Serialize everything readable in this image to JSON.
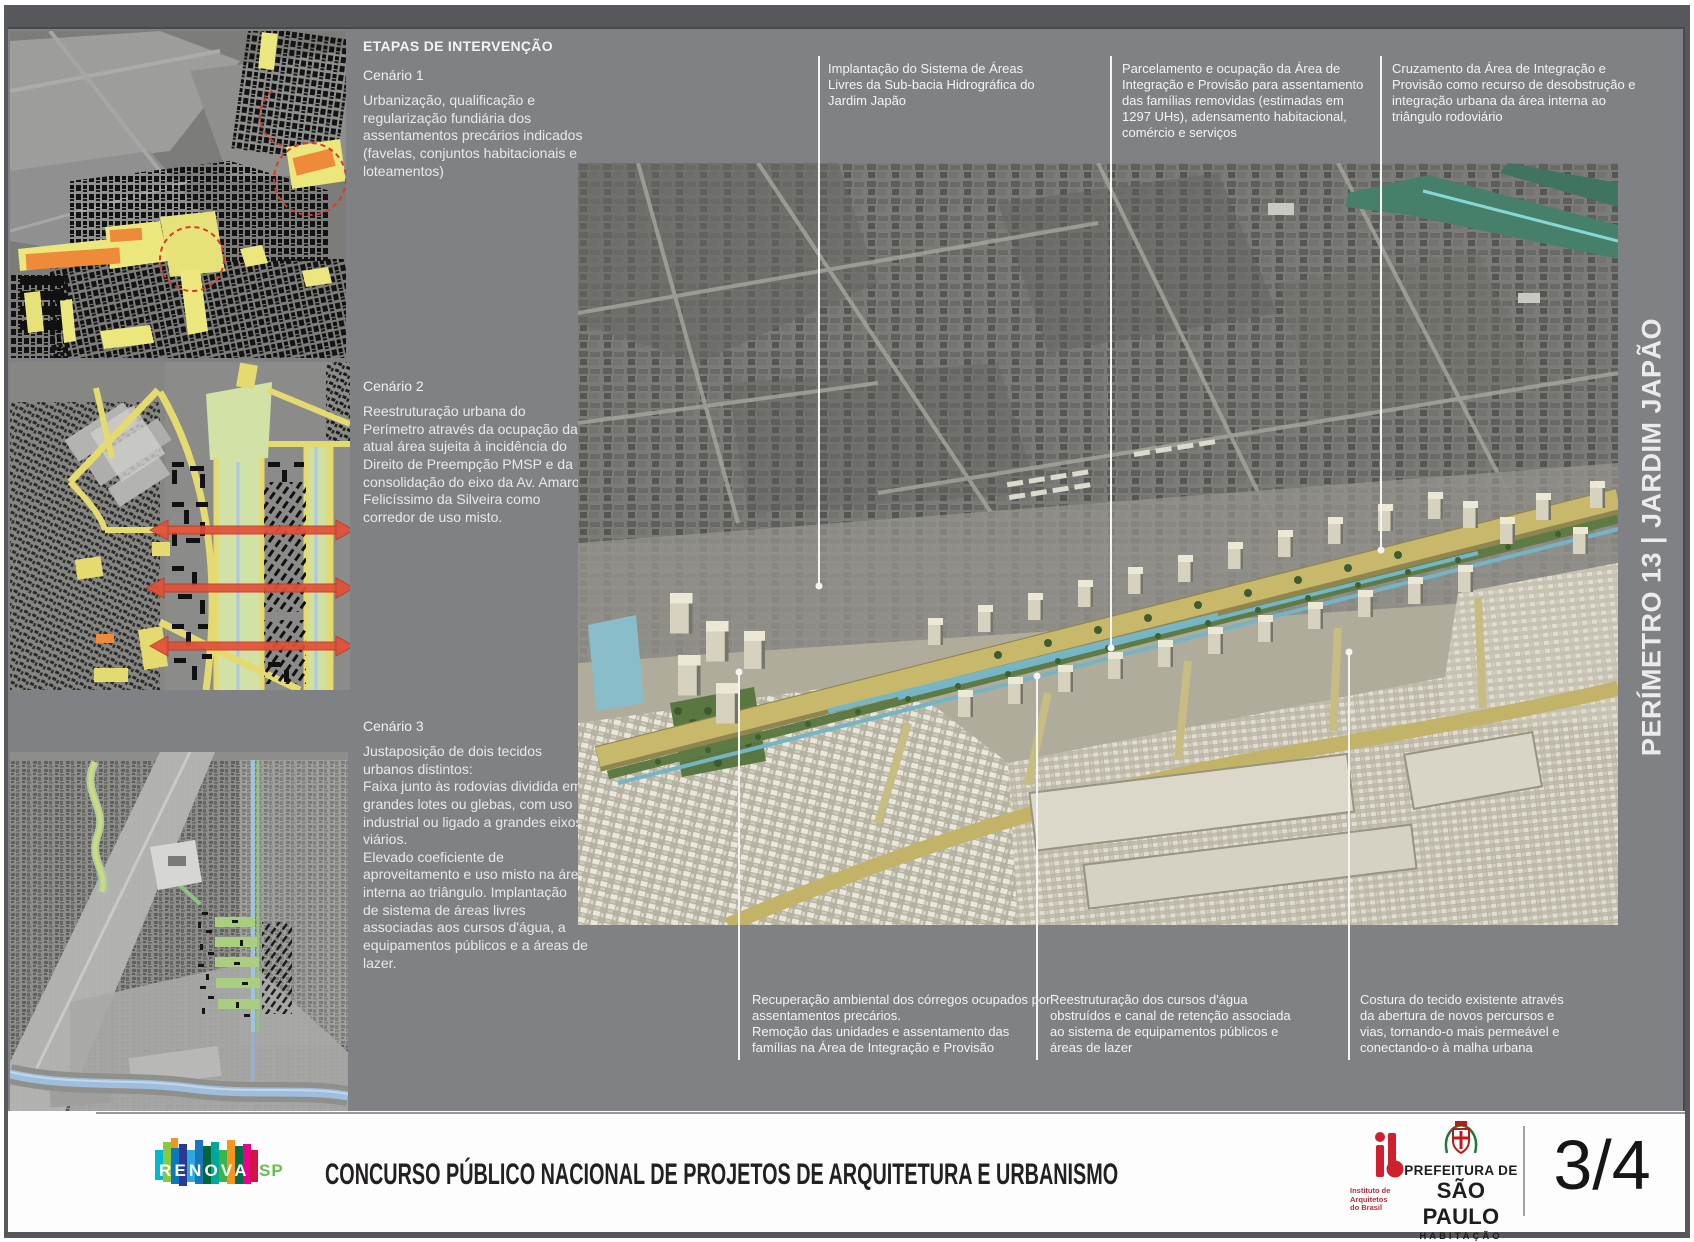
{
  "text_column": {
    "heading": "ETAPAS DE INTERVENÇÃO",
    "scenarios": [
      {
        "title": "Cenário 1",
        "body": "Urbanização, qualificação e\nregularização fundiária dos\nassentamentos precários indicados\n(favelas, conjuntos habitacionais e\nloteamentos)"
      },
      {
        "title": "Cenário 2",
        "body": "Reestruturação urbana do\nPerímetro através da ocupação da\natual área sujeita à incidência do\nDireito de Preempção PMSP e da\nconsolidação do eixo da Av. Amaro\nFelicíssimo da Silveira como\ncorredor de uso misto."
      },
      {
        "title": "Cenário 3",
        "body": "Justaposição de dois tecidos\nurbanos distintos:\nFaixa junto às rodovias dividida em\ngrandes lotes ou glebas, com uso\nindustrial ou ligado a grandes eixos\nviários.\nElevado coeficiente de\naproveitamento e uso misto na área\ninterna ao triângulo. Implantação\nde sistema de áreas livres\nassociadas aos cursos d'água, a\nequipamentos públicos e a áreas de\nlazer."
      }
    ]
  },
  "annotations": {
    "top": [
      "Implantação do Sistema de Áreas\nLivres da Sub-bacia Hidrográfica do\nJardim Japão",
      "Parcelamento e ocupação da Área de\nIntegração e Provisão para assentamento\ndas famílias removidas (estimadas em\n1297 UHs), adensamento habitacional,\ncomércio e serviços",
      "Cruzamento da Área de Integração e\nProvisão como recurso de desobstrução e\nintegração urbana da área interna ao\ntriângulo rodoviário"
    ],
    "bottom": [
      "Recuperação ambiental dos córregos ocupados por\nassentamentos precários.\nRemoção das unidades e assentamento das\nfamílias na Área de Integração e Provisão",
      "Reestruturação dos cursos d'água\nobstruídos e canal de retenção associada\nao sistema de equipamentos públicos e\náreas de lazer",
      "Costura do tecido existente através\nda abertura de novos percursos e\nvias, tornando-o mais permeável e\nconectando-o à malha urbana"
    ]
  },
  "side_title": "PERÍMETRO 13 | JARDIM JAPÃO",
  "footer": {
    "renova_word": "RENOVA",
    "renova_sp": "SP",
    "title": "CONCURSO PÚBLICO NACIONAL DE PROJETOS DE ARQUITETURA E URBANISMO",
    "iab_lines": [
      "Instituto de",
      "Arquitetos",
      "do Brasil"
    ],
    "prefeitura_line1": "PREFEITURA DE",
    "prefeitura_line2": "SÃO PAULO",
    "prefeitura_line3": "HABITAÇÃO",
    "page": "3/4"
  },
  "colors": {
    "panel_gray": "#7f8184",
    "frame_gray": "#56585c",
    "text_white": "#f4f4f2",
    "map_yellow": "#e9e47c",
    "map_orange": "#ef8a3a",
    "arrow_red": "#e25038",
    "iab_red": "#cf2030",
    "sp_green": "#6abf4b",
    "renova_palette": [
      "#00b9d1",
      "#8dc63f",
      "#f7941e",
      "#0e76bc",
      "#2b3990",
      "#29abe2",
      "#1b75bc",
      "#006838",
      "#00a79d",
      "#39b54a",
      "#00704a",
      "#ec008c",
      "#d31245"
    ]
  }
}
